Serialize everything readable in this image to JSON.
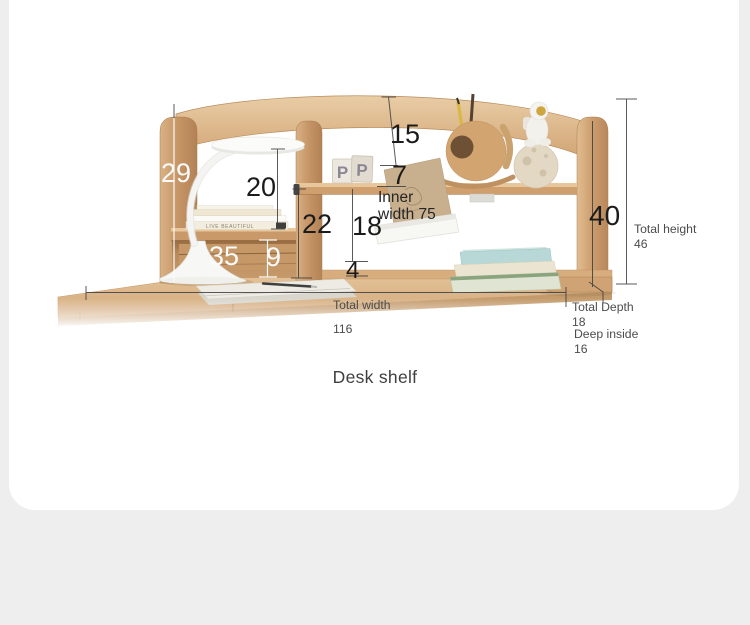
{
  "page": {
    "background_color": "#eeeeee",
    "card_color": "#ffffff",
    "wood_color": "#d2a876",
    "dim_line_dark": "#3d3d3d",
    "dim_line_light": "#fafafa"
  },
  "caption": "Desk shelf",
  "dimensions": {
    "top_gap": "15",
    "shelf_lip": "7",
    "left_panel_height": "29",
    "left_shelf_gap": "20",
    "right_open_height": "22",
    "inner_height": "18",
    "left_cubby_width": "35",
    "under_shelf_height": "9",
    "base_height": "4",
    "right_panel_height": "40",
    "inner_width": "Inner width 75",
    "total_width_label": "Total width",
    "total_width_value": "116",
    "total_depth_label": "Total Depth",
    "total_depth_value": "18",
    "deep_inside_label": "Deep inside",
    "deep_inside_value": "16",
    "total_height_label": "Total height",
    "total_height_value": "46"
  },
  "decor": {
    "block_letter_1": "P",
    "block_letter_2": "P",
    "book_spine_text": "LIVE BEAUTIFUL"
  }
}
